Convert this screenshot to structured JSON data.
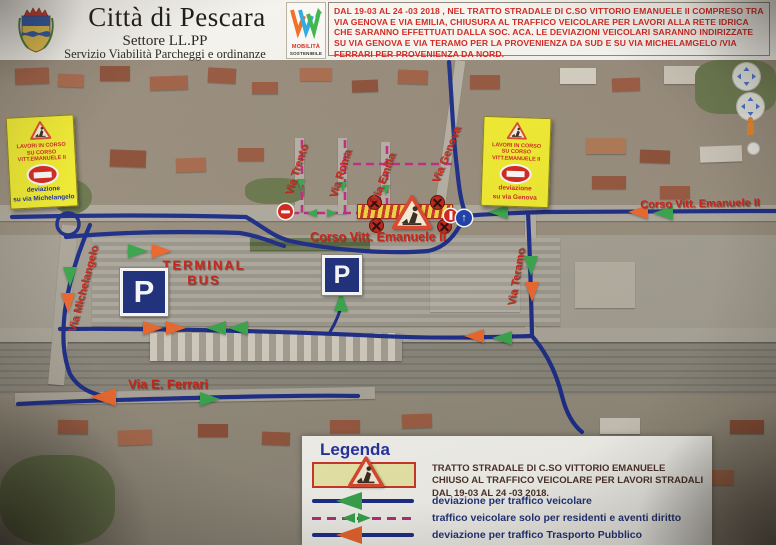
{
  "header": {
    "title": "Città di Pescara",
    "subtitle1": "Settore  LL.PP",
    "subtitle2": "Servizio Viabilità  Parcheggi e ordinanze",
    "logo": {
      "line1": "MOBILITÀ",
      "line2": "SOSTENIBILE"
    },
    "notice": "DAL 19-03 AL 24 -03 2018 , NEL TRATTO STRADALE DI C.SO VITTORIO EMANUELE II COMPRESO TRA VIA GENOVA E VIA EMILIA, CHIUSURA  AL TRAFFICO VEICOLARE PER LAVORI ALLA RETE IDRICA CHE SARANNO EFFETTUATI DALLA SOC. ACA.  LE DEVIAZIONI VEICOLARI SARANNO INDIRIZZATE SU VIA GENOVA  E VIA TERAMO PER LA PROVENIENZA DA SUD E SU VIA MICHELAMGELO /VIA FERRARI PER PROVENIENZA DA NORD."
  },
  "map": {
    "labels": {
      "via_trento": "Via Trento",
      "via_roma": "Via Roma",
      "via_emilia": "Via Emilia",
      "via_genova": "Via Genova",
      "corso_center": "Corso Vitt. Emanuele II",
      "corso_right": "Corso Vitt. Emanuele II",
      "via_teramo": "Via Teramo",
      "via_michelangelo": "Via Michelangelo",
      "terminal_line1": "TERMINAL",
      "terminal_line2": "BUS",
      "via_ferrari": "Via E. Ferrari"
    },
    "parking_symbol": "P",
    "signs": {
      "left_panel": {
        "line1": "LAVORI IN CORSO",
        "line2": "SU CORSO VITT.EMANUELE II",
        "line3": "deviazione",
        "line4": "su via Michelangelo"
      },
      "right_panel": {
        "line1": "LAVORI IN CORSO",
        "line2": "SU CORSO VITT.EMANUELE II",
        "line3": "deviazione",
        "line4": "su via Genova"
      }
    }
  },
  "legend": {
    "title": "Legenda",
    "rows": [
      {
        "text": "TRATTO STRADALE DI C.SO VITTORIO EMANUELE CHIUSO AL TRAFFICO VEICOLARE PER LAVORI STRADALI DAL 19-03 AL 24 -03 2018."
      },
      {
        "text": "deviazione per traffico veicolare"
      },
      {
        "text": "traffico veicolare solo per residenti e aventi diritto"
      },
      {
        "text": "deviazione per traffico Trasporto Pubblico"
      }
    ]
  },
  "icons": {
    "up_arrow": "↑"
  },
  "colors": {
    "route_blue": "#1c2d8a",
    "diversion_green": "#3aa94e",
    "diversion_orange": "#f2692e",
    "residents_magenta": "#c22a86",
    "label_red": "#cf2318",
    "notice_red": "#d5231d",
    "panel_yellow": "#f4ef2f",
    "legend_blue": "#2433a5"
  }
}
